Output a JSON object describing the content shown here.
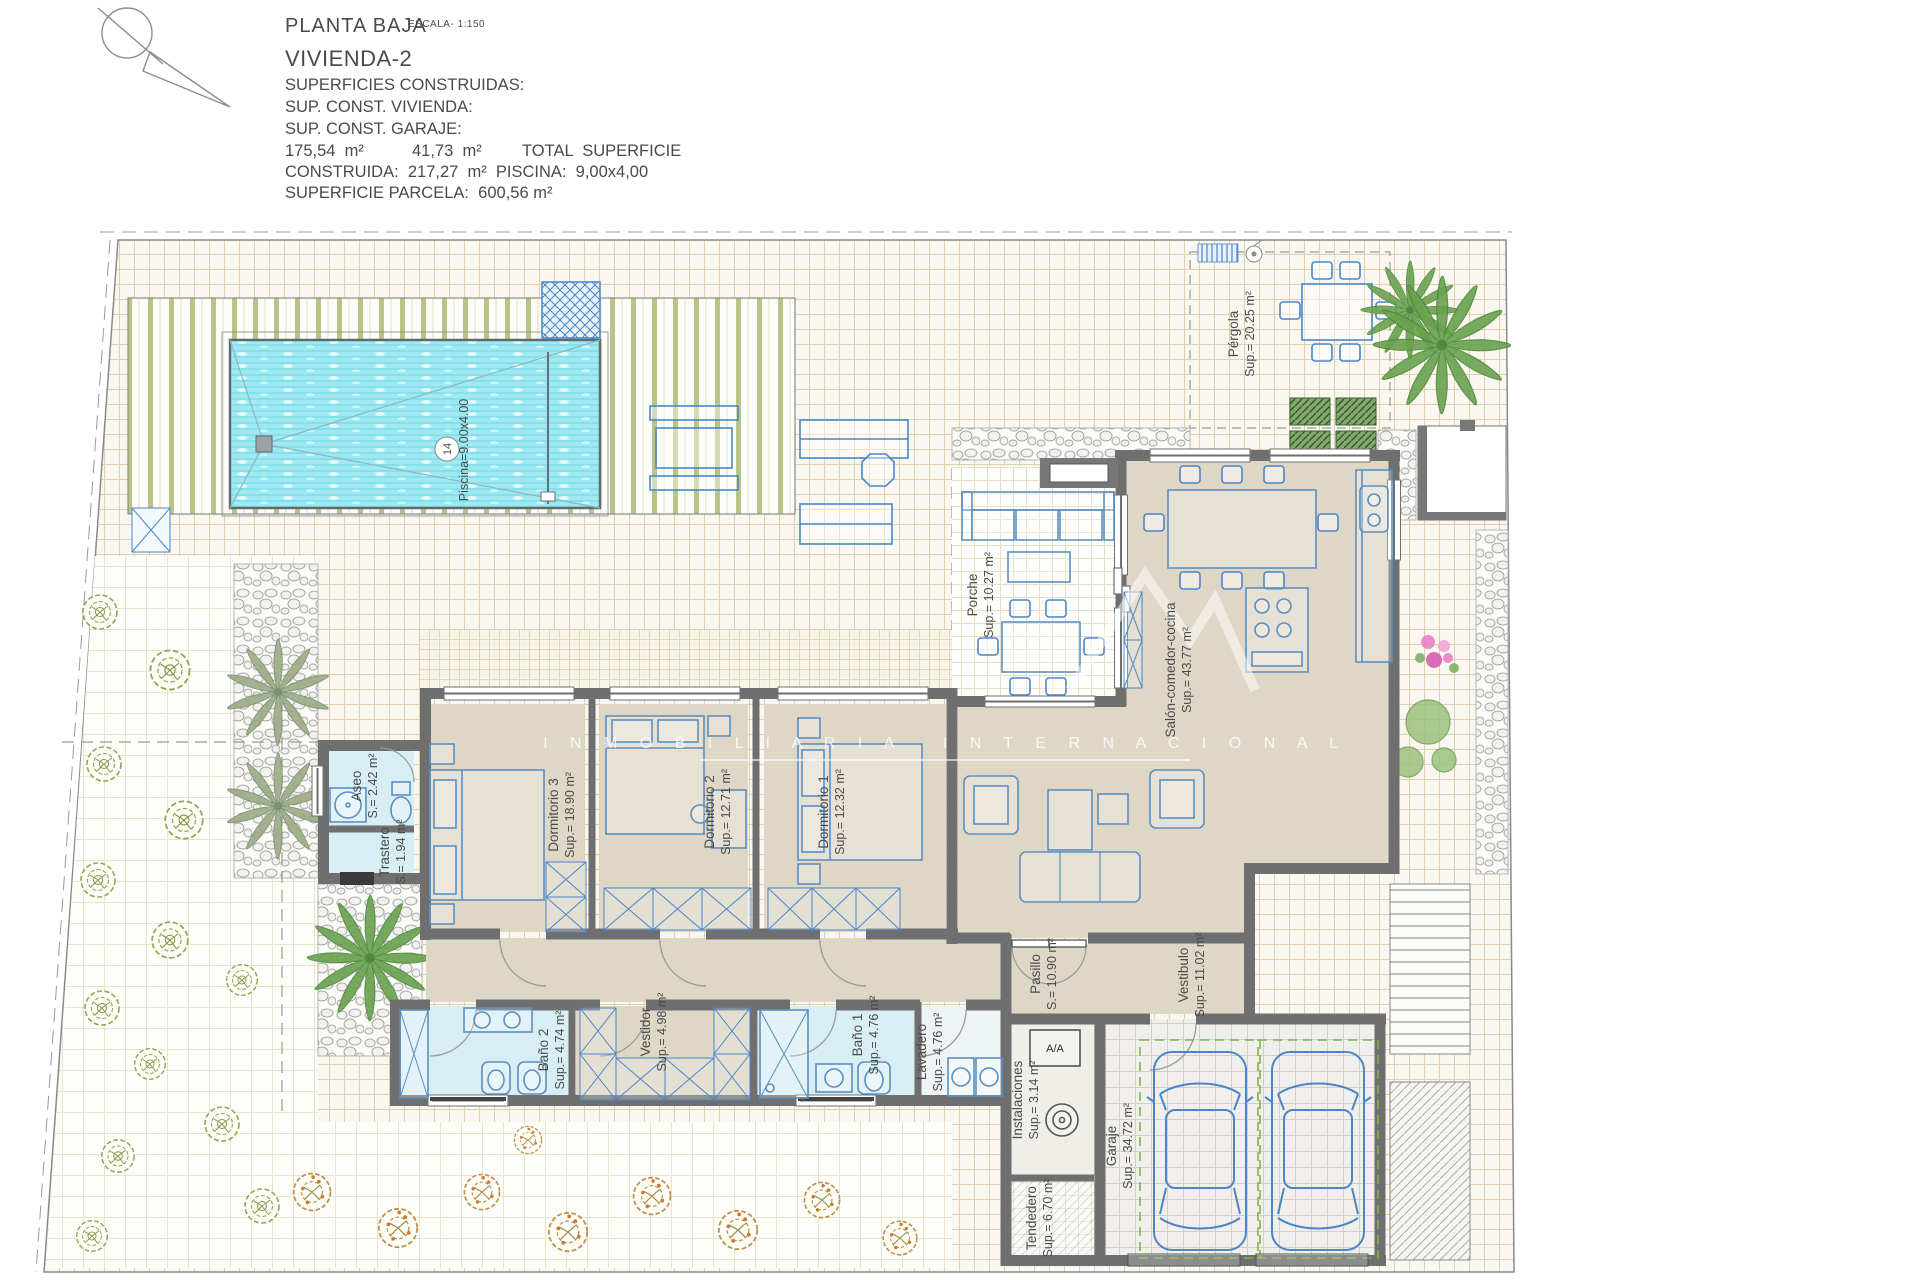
{
  "title_block": {
    "plan_name": "PLANTA BAJA",
    "scale_note": "ESCALA- 1:150",
    "dwelling_name": "VIVIENDA-2",
    "surfaces_heading": "SUPERFICIES CONSTRUIDAS:",
    "sup_vivienda_label": "SUP. CONST. VIVIENDA:",
    "sup_garaje_label": "SUP. CONST. GARAJE:",
    "values": {
      "v1": "175,54  m²",
      "v2": "41,73  m²",
      "v3": "TOTAL  SUPERFICIE"
    },
    "construida_line": "CONSTRUIDA:  217,27  m²  PISCINA:  9,00x4,00",
    "parcela_line": "SUPERFICIE PARCELA:  600,56 m²"
  },
  "rooms": {
    "dormitorio3": {
      "name": "Dormitorio 3",
      "area": "Sup.= 18.90 m²"
    },
    "dormitorio2": {
      "name": "Dormitorio 2",
      "area": "Sup.= 12.71 m²"
    },
    "dormitorio1": {
      "name": "Dormitorio 1",
      "area": "Sup.= 12.32 m²"
    },
    "salon": {
      "name": "Salón-comedor-cocina",
      "area": "Sup.= 43.77 m²"
    },
    "porche": {
      "name": "Porche",
      "area": "Sup.= 10.27 m²"
    },
    "aseo": {
      "name": "Aseo",
      "area": "S.= 2.42 m²"
    },
    "trastero": {
      "name": "Trastero",
      "area": "S.= 1.94 m²"
    },
    "bano2": {
      "name": "Baño 2",
      "area": "Sup.= 4.74 m²"
    },
    "vestidor": {
      "name": "Vestidor",
      "area": "Sup.= 4.98 m²"
    },
    "bano1": {
      "name": "Baño 1",
      "area": "Sup.= 4.76 m²"
    },
    "lavadero": {
      "name": "Lavadero",
      "area": "Sup.= 4.76 m²"
    },
    "pasillo": {
      "name": "Pasillo",
      "area": "S.= 10.90 m²"
    },
    "vestibulo": {
      "name": "Vestibulo",
      "area": "Sup.= 11.02 m²"
    },
    "instalaciones": {
      "name": "Instalaciones",
      "area": "Sup.= 3.14 m²"
    },
    "tendedero": {
      "name": "Tendedero",
      "area": "Sup.= 6.70 m²"
    },
    "garaje": {
      "name": "Garaje",
      "area": "Sup.= 34.72 m²"
    },
    "pergola": {
      "name": "Pérgola",
      "area": "Sup.= 20.25 m²"
    }
  },
  "pool": {
    "tag_number": "14",
    "label": "Piscina=9.00x4.00"
  },
  "equipment": {
    "ac_label": "A/A"
  },
  "watermark": {
    "line": "I N M O B I L I A R I A   I N T E R N A C I O N A L"
  },
  "colors": {
    "water": "#a0e9f2",
    "house_floor": "#ded7c6",
    "wet_floor": "#d8eef5",
    "wall": "#6f6f6f",
    "furniture": "#5b8fc0",
    "deck_stripe": "#b9c386",
    "paving_line": "#ddd0ad",
    "label_text": "#3f3f3f",
    "parking_dash": "#7ab648"
  }
}
